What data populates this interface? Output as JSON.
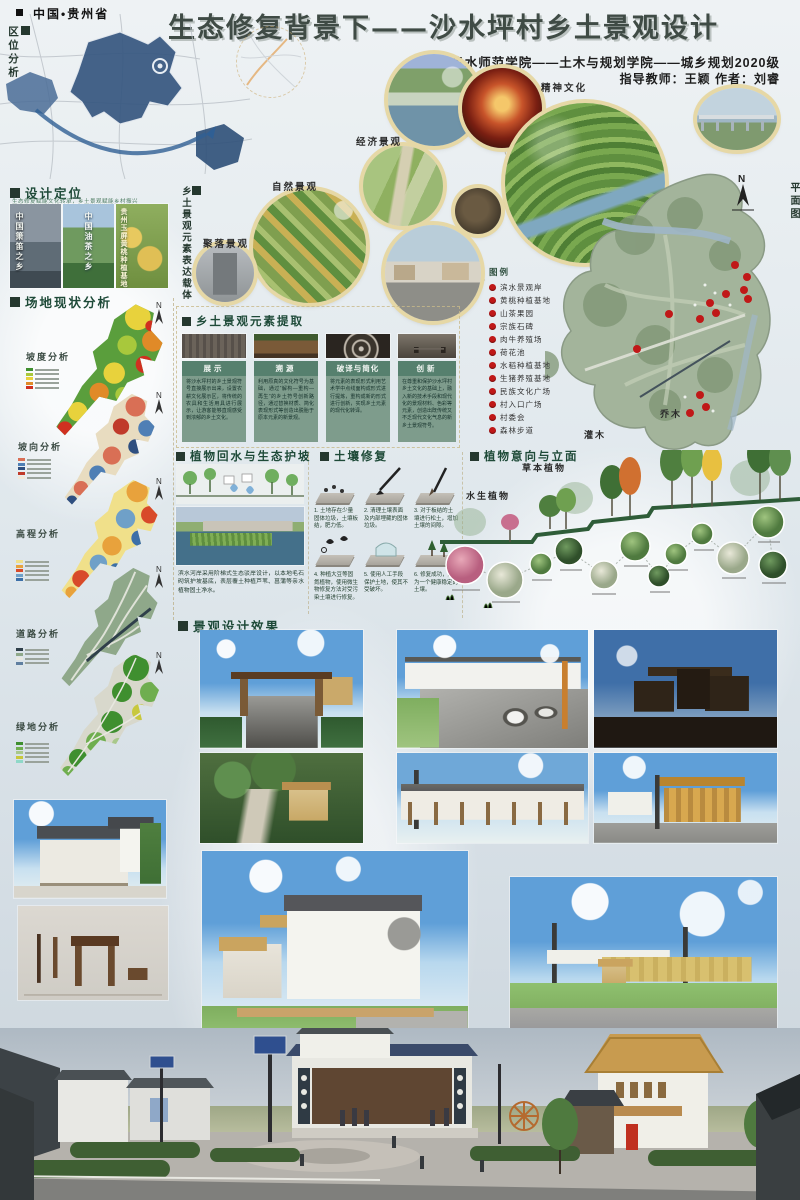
{
  "colors": {
    "ink_green": "#1e4a38",
    "sage": "#56806e",
    "legend_red": "#c01818",
    "map_blue": "#31527e",
    "gold_ring": "#e6d8a6"
  },
  "header": {
    "region": "中国•贵州省",
    "title": "生态修复背景下——沙水坪村乡土景观设计",
    "school": "六盘水师范学院——土木与规划学院——城乡规划2020级",
    "credits": "指导教师：王颖  作者：刘睿"
  },
  "location": {
    "label": "区位分析"
  },
  "positioning": {
    "label": "设计定位",
    "caption": "生态修复赋能文化转承，乡土景观赋能乡村振兴",
    "cards": [
      "中国箫笛之乡",
      "中国油茶之乡",
      "贵州玉屏黄桃种植基地"
    ]
  },
  "site": {
    "label": "场地现状分析",
    "north": "N",
    "maps": [
      "坡度分析",
      "坡向分析",
      "高程分析",
      "道路分析",
      "绿地分析"
    ]
  },
  "carrier": {
    "label": "乡土景观元素表达载体",
    "circles": [
      "精神文化",
      "经济景观",
      "自然景观",
      "聚落景观"
    ]
  },
  "plan": {
    "label": "平面图",
    "north": "N",
    "legend_title": "图例",
    "shrub": "灌木",
    "arbor": "乔木",
    "legend": [
      "滨水景观岸",
      "黄桃种植基地",
      "山茶果园",
      "宗族石碑",
      "肉牛养殖场",
      "荷花池",
      "水稻种植基地",
      "生猪养殖基地",
      "民族文化广场",
      "村入口广场",
      "村委会",
      "森林步道"
    ]
  },
  "extraction": {
    "label": "乡土景观元素提取",
    "cols": [
      {
        "title": "展示",
        "text": "将沙水坪村的乡土景观符号直接展示出来，设置农耕文化展示区，将传统的农具和生活用具进行展示，让游客能够直观感受到浓郁的乡土文化。"
      },
      {
        "title": "溯源",
        "text": "利用原真的文化符号为基础，通过“解构—重构—再生”的乡土符号创新路径，通过替换材质、简化表现形式等创造出脱胎于原本元素的新景观。"
      },
      {
        "title": "破译与简化",
        "text": "将元素的表现形式利用艺术学中点线面构成形式进行提炼，重构成新的形式进行创新，实现乡土元素的现代化转译。"
      },
      {
        "title": "创新",
        "text": "在尊重和保护沙水坪村乡土文化的基础上，融入新的技术手段和现代化的景观材料、色彩等元素，创造出既传统又不乏现代文化气息的新乡土景观符号。"
      }
    ]
  },
  "slope": {
    "label": "植物回水与生态护坡",
    "text": "滨水河岸采用阶梯式生态驳岸设计，以本地毛石砌筑护坡基底，表层覆土种植芦苇、菖蒲等亲水植物固土净水。"
  },
  "soil": {
    "label": "土壤修复",
    "steps": [
      "1. 土地存在少量固体垃圾，土壤板结，肥力低。",
      "2. 清理土壤表面及内部埋藏的固体垃圾。",
      "3. 对于板结的土壤进行松土，增加土壤的间隙。",
      "4. 种植大豆等固氮植物，使用微生物修复方法对受污染土壤进行修复。",
      "5. 使用人工手段保护土地，使其不受破坏。",
      "6. 修复成功，成为一个健康稳定的土壤。"
    ]
  },
  "plants": {
    "label": "植物意向与立面",
    "herb": "草本植物",
    "aquatic": "水生植物"
  },
  "effects": {
    "label": "景观设计效果"
  }
}
